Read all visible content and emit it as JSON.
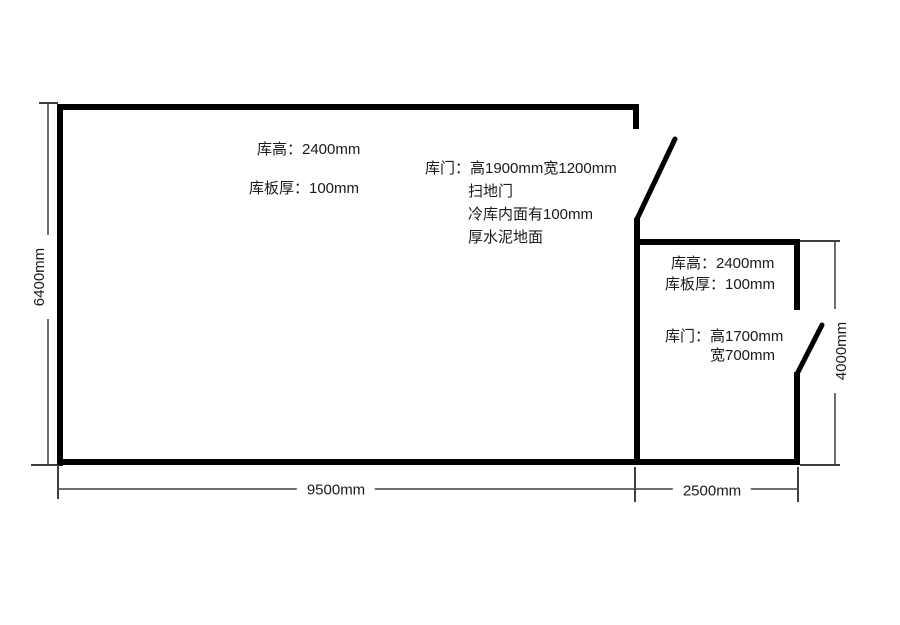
{
  "colors": {
    "background": "#ffffff",
    "wall": "#000000",
    "dim_line": "#6e6e6e",
    "tick": "#3f3f3f",
    "text": "#1a1a1a"
  },
  "large_room": {
    "note_height": "库高：2400mm",
    "note_panel_thickness": "库板厚：100mm",
    "door_note": {
      "line1": "库门：高1900mm宽1200mm",
      "line2": "扫地门",
      "line3": "冷库内面有100mm",
      "line4": "厚水泥地面"
    },
    "width_dim": "9500mm",
    "height_dim": "6400mm"
  },
  "small_room": {
    "note_height": "库高：2400mm",
    "note_panel_thickness": "库板厚：100mm",
    "door_note": {
      "line1": "库门：高1700mm",
      "line2": "宽700mm"
    },
    "width_dim": "2500mm",
    "height_dim": "4000mm"
  }
}
